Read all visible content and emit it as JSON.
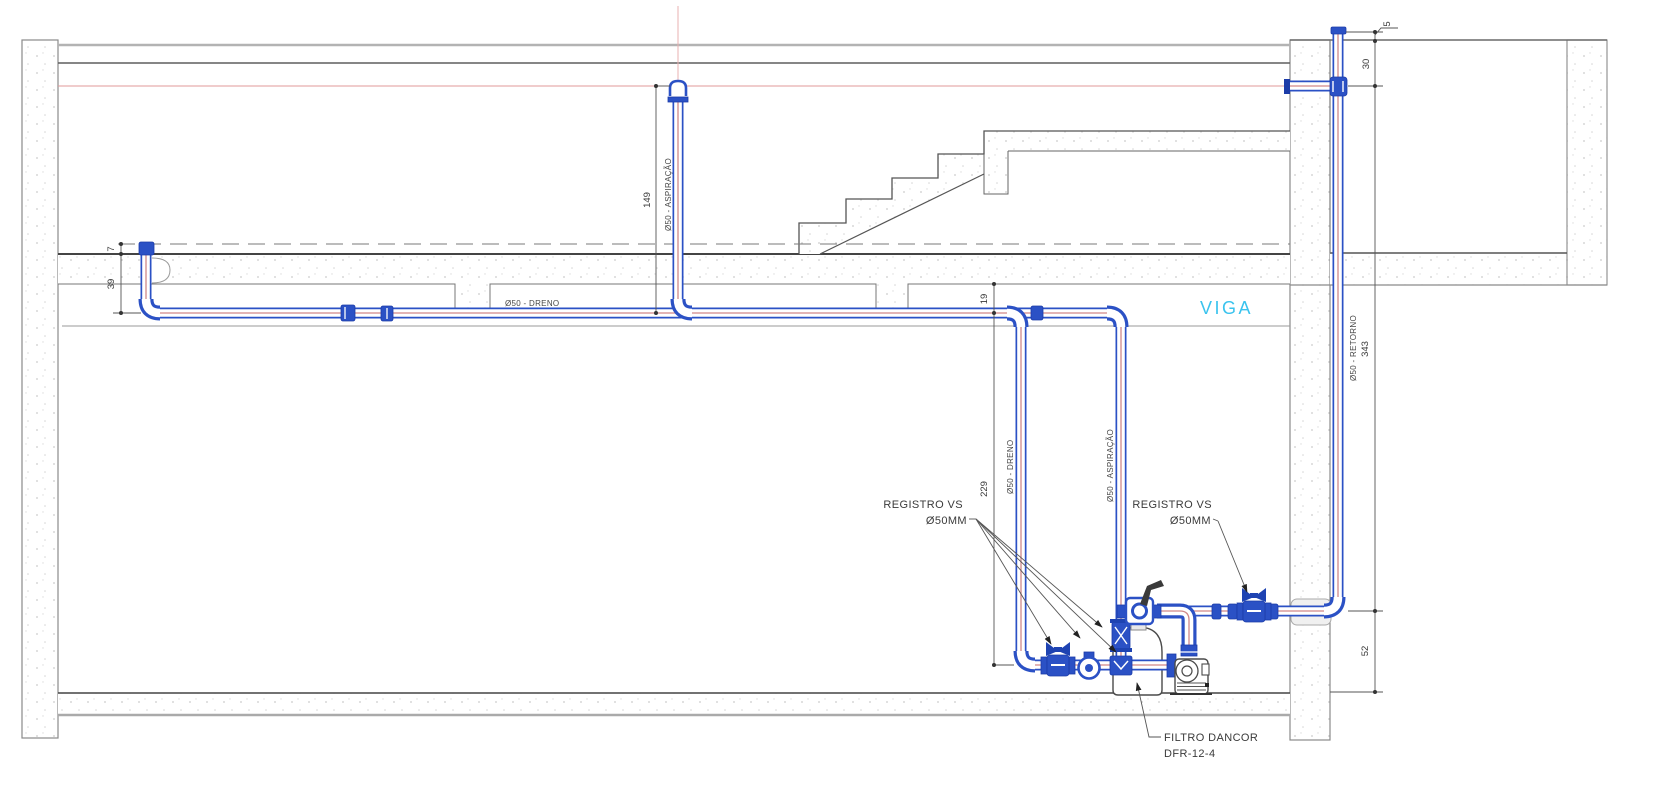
{
  "title": "Pool piping section drawing",
  "labels": {
    "dreno": "Ø50 - DRENO",
    "aspiracao": "Ø50 - ASPIRAÇÃO",
    "retorno": "Ø50 - RETORNO",
    "viga": "VIGA",
    "registro_vs": "REGISTRO VS",
    "registro_size": "Ø50MM",
    "filtro_line1": "FILTRO DANCOR",
    "filtro_line2": "DFR-12-4"
  },
  "dimensions": {
    "d7": "7",
    "d39": "39",
    "d149": "149",
    "d19": "19",
    "d229": "229",
    "d343": "343",
    "d52": "52",
    "d30": "30",
    "d5": "5"
  },
  "colors": {
    "pipe_blue": "#2b51c5",
    "centerline_red": "#d08888",
    "water_level_red": "#e09999",
    "viga_cyan": "#3ac3ee",
    "structure_gray": "#8a8a8a",
    "text_dark": "#3a3a3a"
  }
}
